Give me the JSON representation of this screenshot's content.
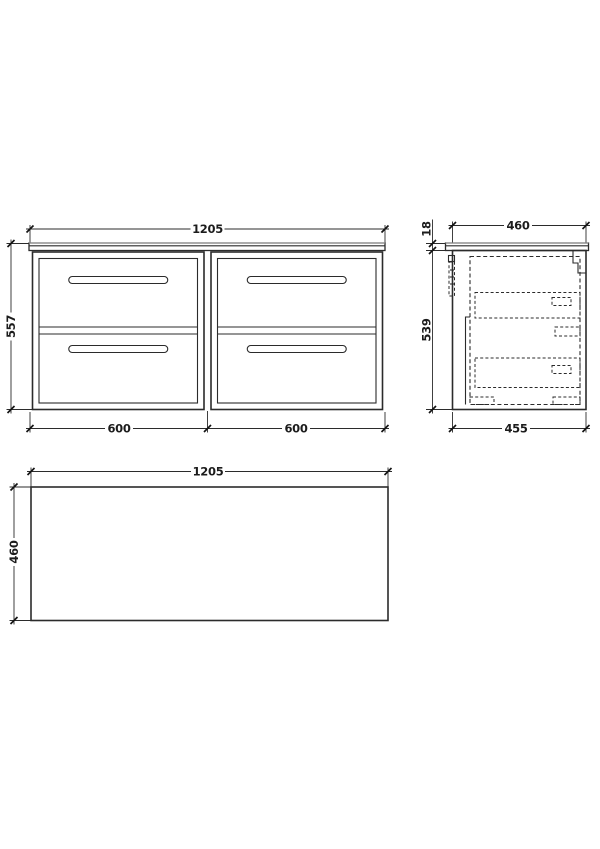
{
  "front_view": {
    "width_label": "1205",
    "height_label": "557",
    "left_section_label": "600",
    "right_section_label": "600"
  },
  "side_view": {
    "worktop_depth_label": "460",
    "worktop_thickness_label": "18",
    "cabinet_height_label": "539",
    "cabinet_depth_label": "455"
  },
  "plan_view": {
    "width_label": "1205",
    "depth_label": "460"
  },
  "colors": {
    "line": "#2b2b2b",
    "background": "#ffffff",
    "dim_text": "#1c1c1c"
  }
}
